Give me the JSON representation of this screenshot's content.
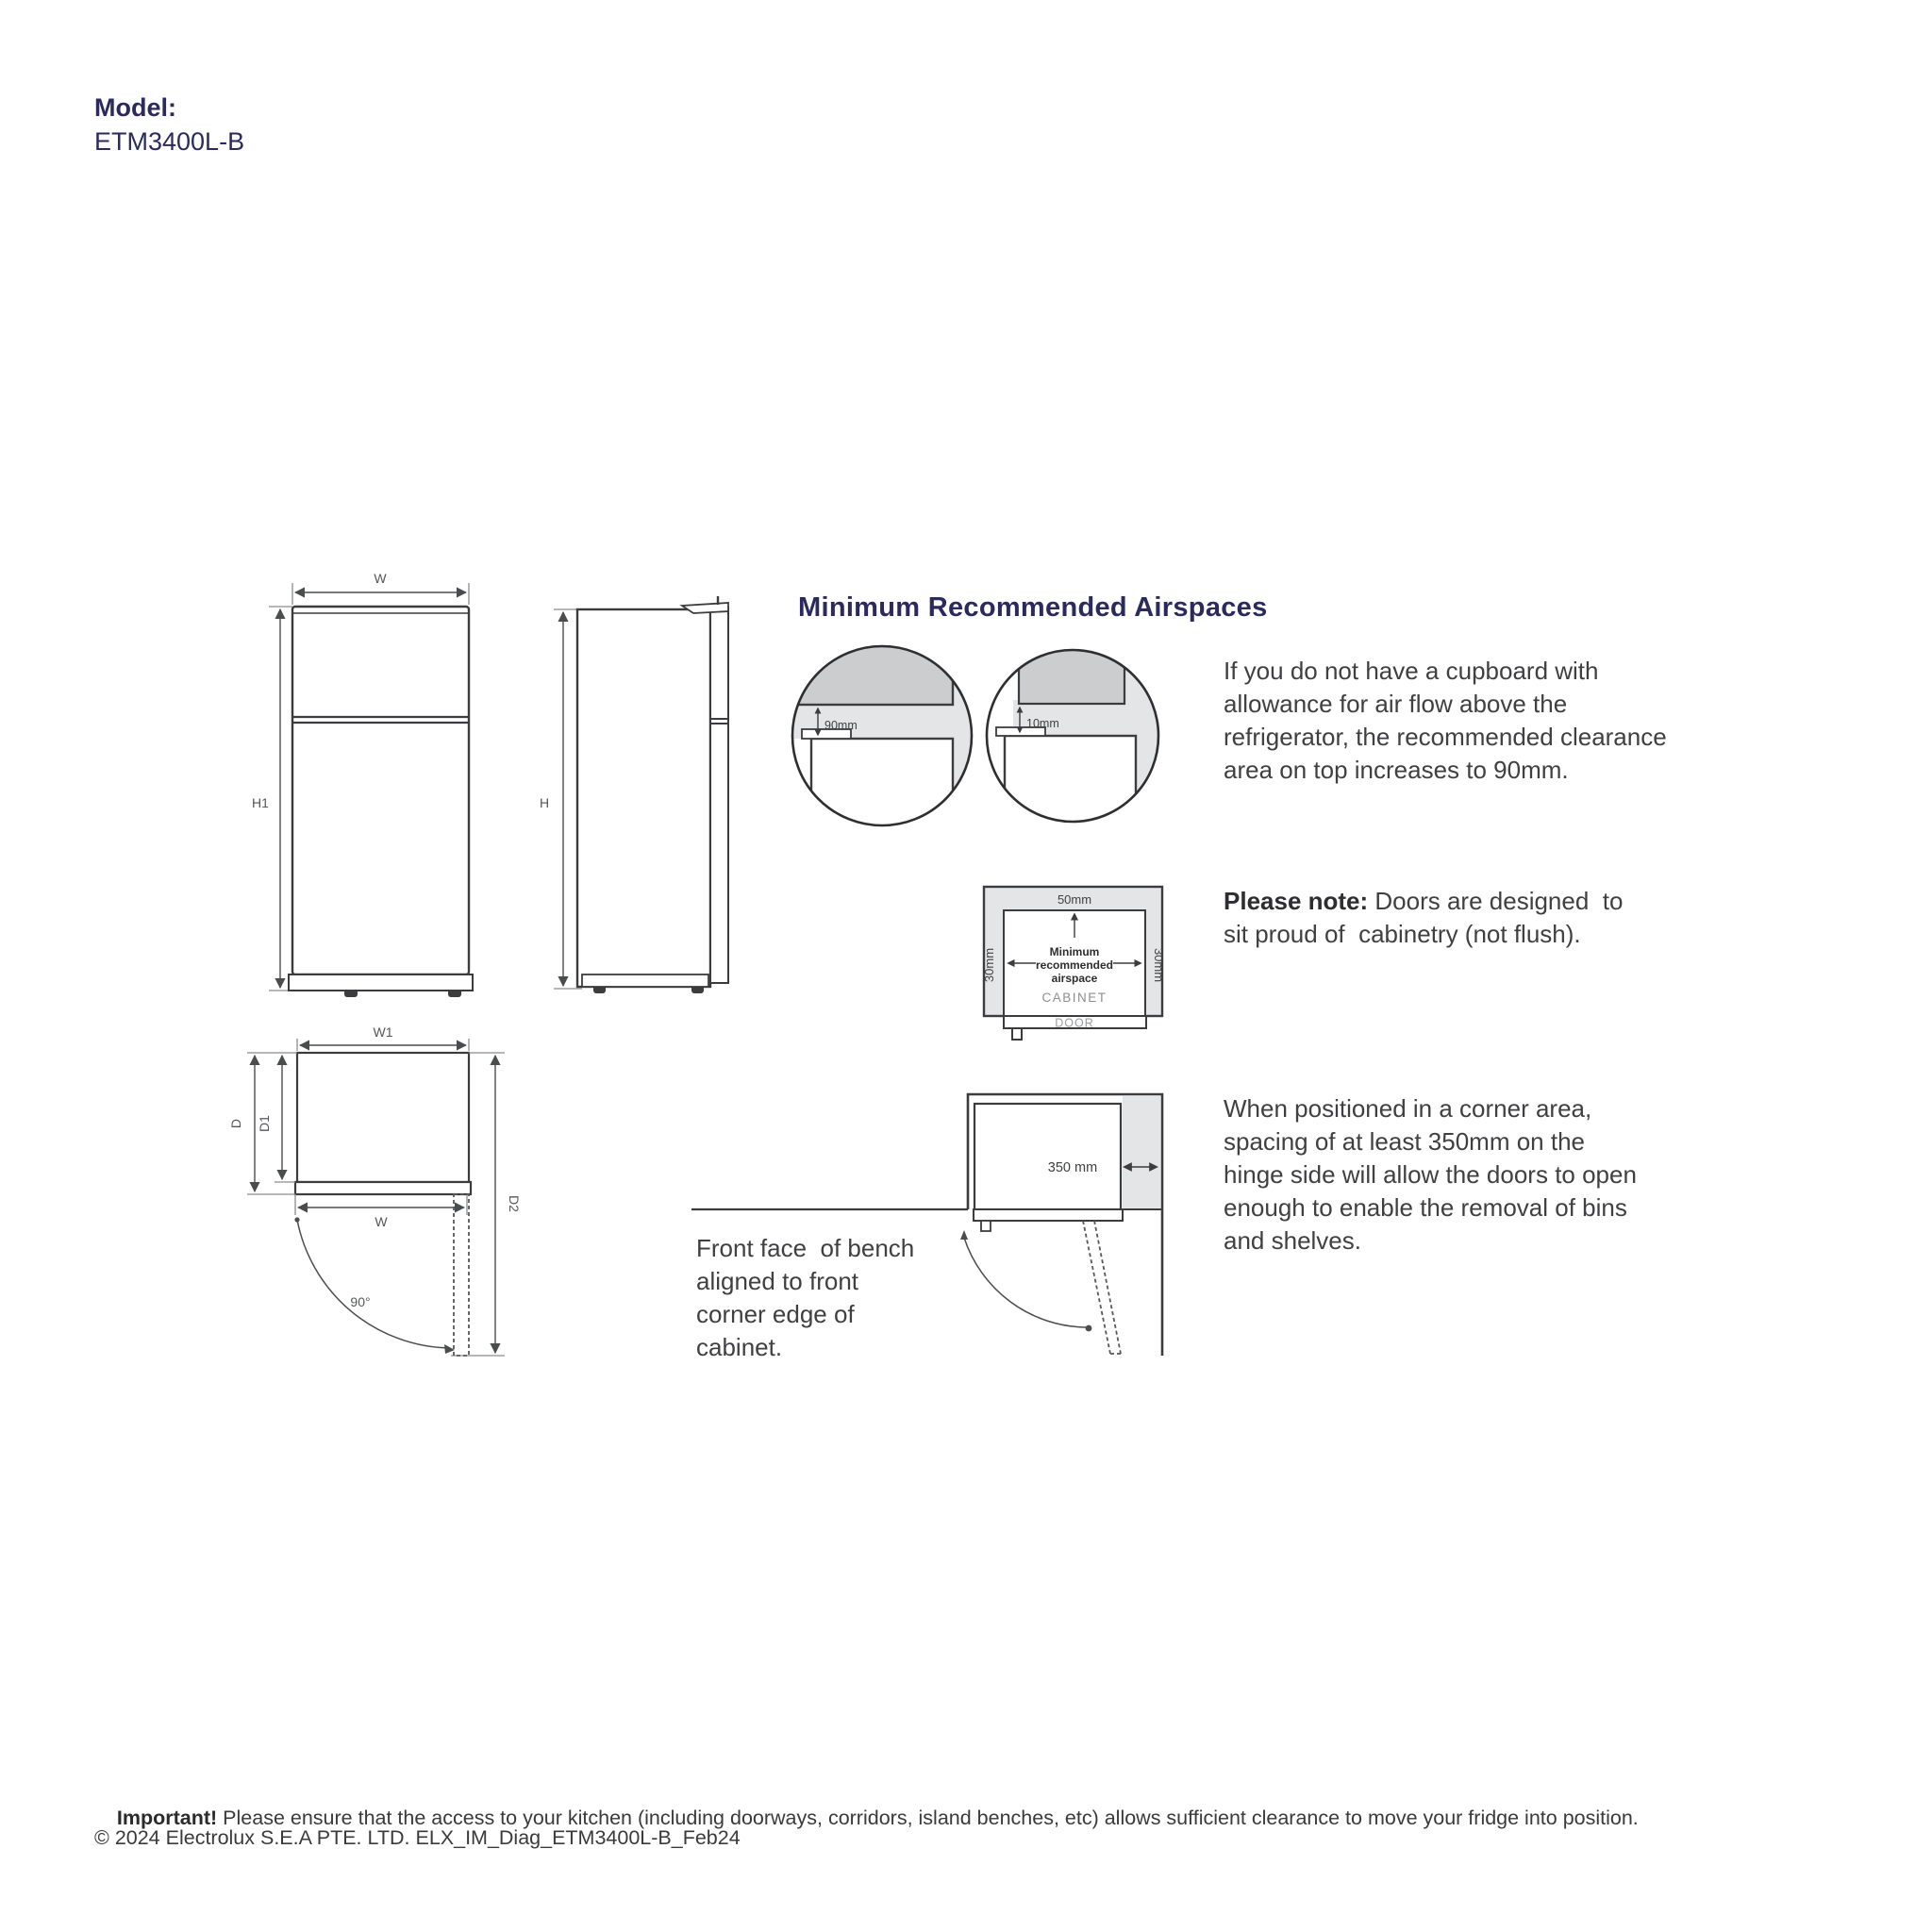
{
  "model": {
    "label": "Model:",
    "number": "ETM3400L-B"
  },
  "section": {
    "heading": "Minimum Recommended Airspaces"
  },
  "front_view": {
    "width": "W",
    "height": "H1"
  },
  "side_view": {
    "height": "H"
  },
  "top_view": {
    "width1": "W1",
    "depth": "D",
    "depth1": "D1",
    "width": "W",
    "depth2": "D2",
    "door_angle": "90°"
  },
  "airspace_circles": {
    "no_cupboard_clearance": "90mm",
    "cupboard_clearance": "10mm"
  },
  "cabinet_diagram": {
    "top_clearance": "50mm",
    "left_clearance": "30mm",
    "right_clearance": "30mm",
    "center_line1": "Minimum",
    "center_line2": "recommended",
    "center_line3": "airspace",
    "cabinet_label": "CABINET",
    "door_label": "DOOR"
  },
  "corner_diagram": {
    "hinge_spacing": "350 mm"
  },
  "paragraphs": {
    "airflow_lines": [
      "If you do not have a cupboard with",
      "allowance for air flow above the",
      "refrigerator, the recommended clearance",
      "area on top increases to 90mm."
    ],
    "note_label": "Please note:",
    "note_line1_rest": " Doors are designed  to",
    "note_line2": "sit proud of  cabinetry (not flush).",
    "corner_lines": [
      "When positioned in a corner area,",
      "spacing of at least 350mm on the",
      "hinge side will allow the doors to open",
      "enough to enable the removal of bins",
      "and shelves."
    ],
    "bench_lines": [
      "Front face  of bench",
      "aligned to front",
      "corner edge of",
      "cabinet."
    ]
  },
  "footer": {
    "important_label": "Important!",
    "important_text": " Please ensure that the access to your kitchen (including doorways, corridors, island benches, etc) allows sufficient clearance to move your fridge into position.",
    "copyright": "© 2024 Electrolux S.E.A PTE. LTD. ELX_IM_Diag_ETM3400L-B_Feb24"
  },
  "colors": {
    "navy": "#2b2a5e",
    "body_text": "#404042",
    "diagram_line": "#3c3c3e",
    "light_gray_fill": "#e4e5e7",
    "dark_gray_fill": "#cbcdcf",
    "dim_text": "#54565a"
  }
}
